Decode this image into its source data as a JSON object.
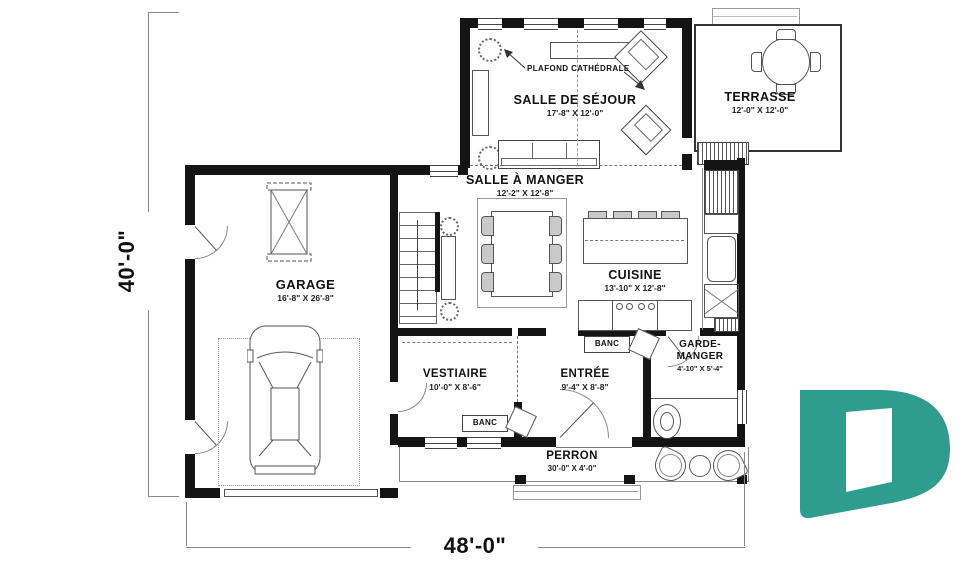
{
  "plan": {
    "rooms": {
      "sejour": {
        "name": "SALLE DE SÉJOUR",
        "dims": "17'-8\" X 12'-0\""
      },
      "terrasse": {
        "name": "TERRASSE",
        "dims": "12'-0\" X 12'-0\""
      },
      "salle_a_manger": {
        "name": "SALLE À MANGER",
        "dims": "12'-2\" X 12'-8\""
      },
      "cuisine": {
        "name": "CUISINE",
        "dims": "13'-10\" X 12'-8\""
      },
      "garage": {
        "name": "GARAGE",
        "dims": "16'-8\" X 26'-8\""
      },
      "vestiaire": {
        "name": "VESTIAIRE",
        "dims": "10'-0\" X 8'-6\""
      },
      "entree": {
        "name": "ENTRÉE",
        "dims": "9'-4\" X 8'-8\""
      },
      "garde_manger": {
        "name_line1": "GARDE-",
        "name_line2": "MANGER",
        "dims": "4'-10\" X 5'-4\""
      },
      "perron": {
        "name": "PERRON",
        "dims": "30'-0\" X 4'-0\""
      }
    },
    "annotations": {
      "plafond_cathedrale": "PLAFOND CATHÉDRALE",
      "banc": "BANC"
    },
    "overall_dimensions": {
      "width": "48'-0\"",
      "depth": "40'-0\""
    },
    "colors": {
      "walls": "#141414",
      "lines": "#555555",
      "logo": "#2E9C8E"
    }
  }
}
